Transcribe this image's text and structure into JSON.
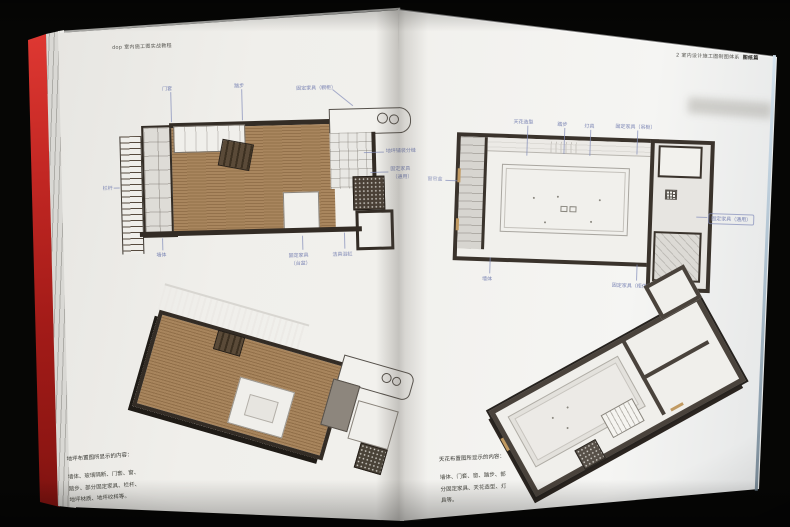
{
  "photo": {
    "description": "Open tutorial book on black background, spread showing floor-plan and ceiling-plan drawings",
    "cover_color": "#c22723",
    "label_color": "#7a84b4",
    "page_color": "#f1f0ec"
  },
  "left_page": {
    "header": "dop 室内施工图实战教程",
    "plan": {
      "name": "地坪布置图",
      "labels": {
        "door_frame": "门套",
        "steps": "踏步",
        "fixed_furniture_top": "固定家具（橱柜）",
        "floor_paving": "地坪铺装分缝",
        "fixed_right_1": "固定家具",
        "fixed_right_2": "（通用）",
        "railing": "栏杆",
        "wall": "墙体",
        "fixed_bottom_1": "固定家具",
        "fixed_bottom_2": "（台盆）",
        "sanitary": "洁具浴缸"
      }
    },
    "caption": {
      "title": "地坪布置图所显示的内容：",
      "line1": "墙体、玻璃隔断、门套、窗、",
      "line2": "踏步、部分固定家具、栏杆、",
      "line3": "地坪材质、地坪纹样等。"
    }
  },
  "right_page": {
    "header": "2 室内设计施工图制图体系",
    "header_bold": "图纸篇",
    "plan": {
      "name": "天花布置图",
      "labels": {
        "ceiling_shape": "天花造型",
        "steps": "踏步",
        "lamps": "灯具",
        "fixed_top": "固定家具（吊柜）",
        "curtain_box": "窗帘盒",
        "fixed_right": "固定家具（通用）",
        "wall": "墙体",
        "fixed_bottom": "固定家具（柜体）"
      }
    },
    "caption": {
      "title": "天花布置图所显示的内容：",
      "line1": "墙体、门套、窗、踏步、部",
      "line2": "分固定家具、天花造型、灯",
      "line3": "具等。"
    }
  }
}
